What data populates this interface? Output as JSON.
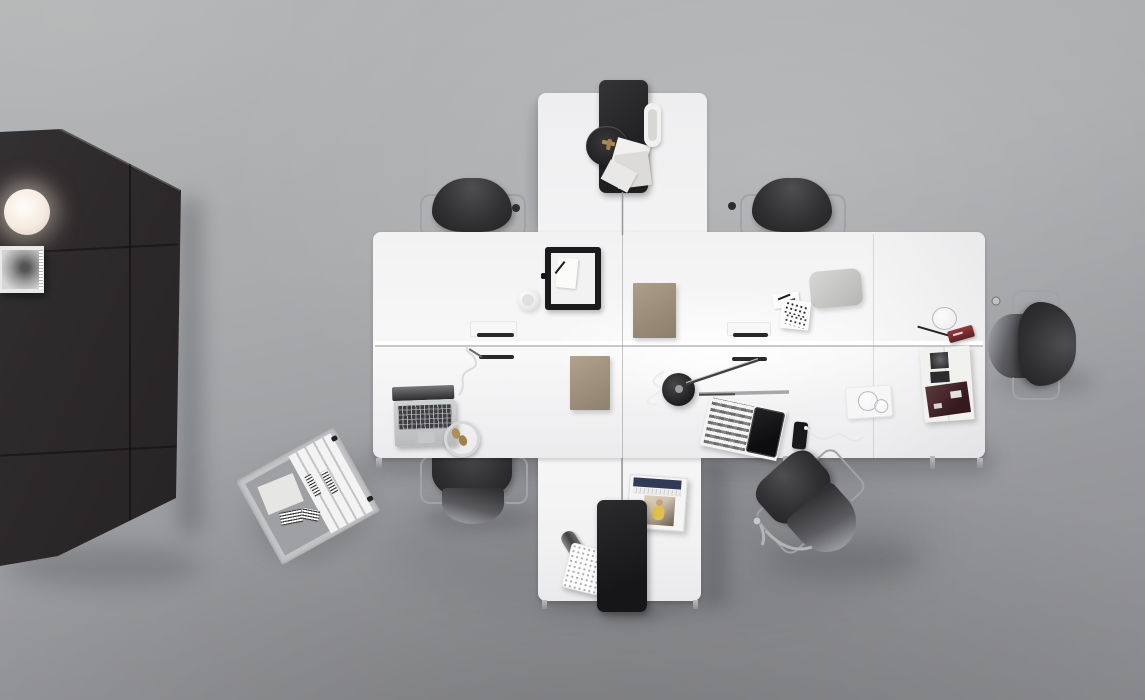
{
  "image": {
    "kind": "photograph",
    "view": "top-down overhead",
    "subject": "Minimalist office workspace with cross-shaped white desk cluster",
    "description": "Overhead photograph of a modern office: a white cross-shaped desk cluster with two black privacy panels, six dark chairs, a tall dark storage cabinet with a glowing globe lamp and a magazine shelf, an archive box of white binders on the floor, and assorted desk accessories on a gray concrete floor.",
    "visible_text": "none — no legible text appears in the image"
  },
  "palette": {
    "floor_light": "#b3b5b6",
    "floor_dark": "#8c8d90",
    "desk_white": "#f5f5f6",
    "cabinet_dark": "#2e2b2c",
    "panel_black": "#1f1f21",
    "chair_gray": "#39393b",
    "chrome": "#a2a3a6",
    "folder_tan": "#a3947f",
    "lamp_glow": "#fdf6ec",
    "accent_red": "#7e2a2c",
    "accent_blue": "#323b56",
    "accent_gold": "#b08d4f"
  },
  "objects": {
    "floor": {
      "label": "gray concrete floor"
    },
    "cabinet": {
      "label": "tall dark storage cabinet with panel seams"
    },
    "sphere_lamp": {
      "label": "glowing white globe lamp on cabinet"
    },
    "shelf": {
      "label": "magazine shelf with black-and-white magazine"
    },
    "archive_box": {
      "label": "tilted archive box with white labelled binders"
    },
    "chair_top_left": {
      "label": "dark office chair, top left workstation"
    },
    "chair_top_right": {
      "label": "dark office chair, top right workstation"
    },
    "chair_right": {
      "label": "dark office chair at right end of desk"
    },
    "chair_bottom_left": {
      "label": "dark office chair, bottom left workstation"
    },
    "chair_bottom_right": {
      "label": "dark office chair pulled away, bottom right"
    },
    "desk_band": {
      "label": "white double-row desk bench"
    },
    "desk_top": {
      "label": "white desk extension, top"
    },
    "desk_bottom": {
      "label": "white desk extension, bottom"
    },
    "panel_top": {
      "label": "black privacy panel on top desk"
    },
    "panel_bottom": {
      "label": "black privacy panel on bottom desk"
    },
    "round_tray": {
      "label": "round dark tray with brass object"
    },
    "papers": {
      "label": "scattered white papers"
    },
    "pen_tray_top": {
      "label": "white oval pen tray"
    },
    "frame_tray": {
      "label": "black framed valet tray with notepad and pen"
    },
    "cup": {
      "label": "white coffee cup"
    },
    "paper_tray_left": {
      "label": "flat white paper tray, left"
    },
    "paper_tray_right": {
      "label": "flat white paper tray, right"
    },
    "pen_slots": {
      "label": "recessed black pen slots in desktop"
    },
    "folder_left": {
      "label": "tan document folder, lower left quadrant"
    },
    "folder_right": {
      "label": "tan document folder, upper right quadrant"
    },
    "cushion": {
      "label": "gray laptop sleeve"
    },
    "pen_holder": {
      "label": "white perforated pen holder with pens"
    },
    "glass_jar": {
      "label": "clear glass jar"
    },
    "pens": {
      "label": "two pens"
    },
    "red_tin": {
      "label": "small dark red pencil tin"
    },
    "open_book": {
      "label": "open photo book with dark images"
    },
    "glass_tray": {
      "label": "white tray with drinking glasses"
    },
    "desk_lamp": {
      "label": "black task lamp with chrome arms and white cord"
    },
    "magazine_tablet": {
      "label": "magazine with black tablet on top"
    },
    "phone": {
      "label": "black smartphone with white earbuds"
    },
    "magazine_file": {
      "label": "magazine file box with magazines"
    },
    "paper_roll": {
      "label": "rolled gray paper tube"
    },
    "waste_bin": {
      "label": "white perforated waste bin"
    },
    "laptop": {
      "label": "silver open laptop"
    },
    "headphones": {
      "label": "silver headphones with tan ear pads"
    }
  }
}
